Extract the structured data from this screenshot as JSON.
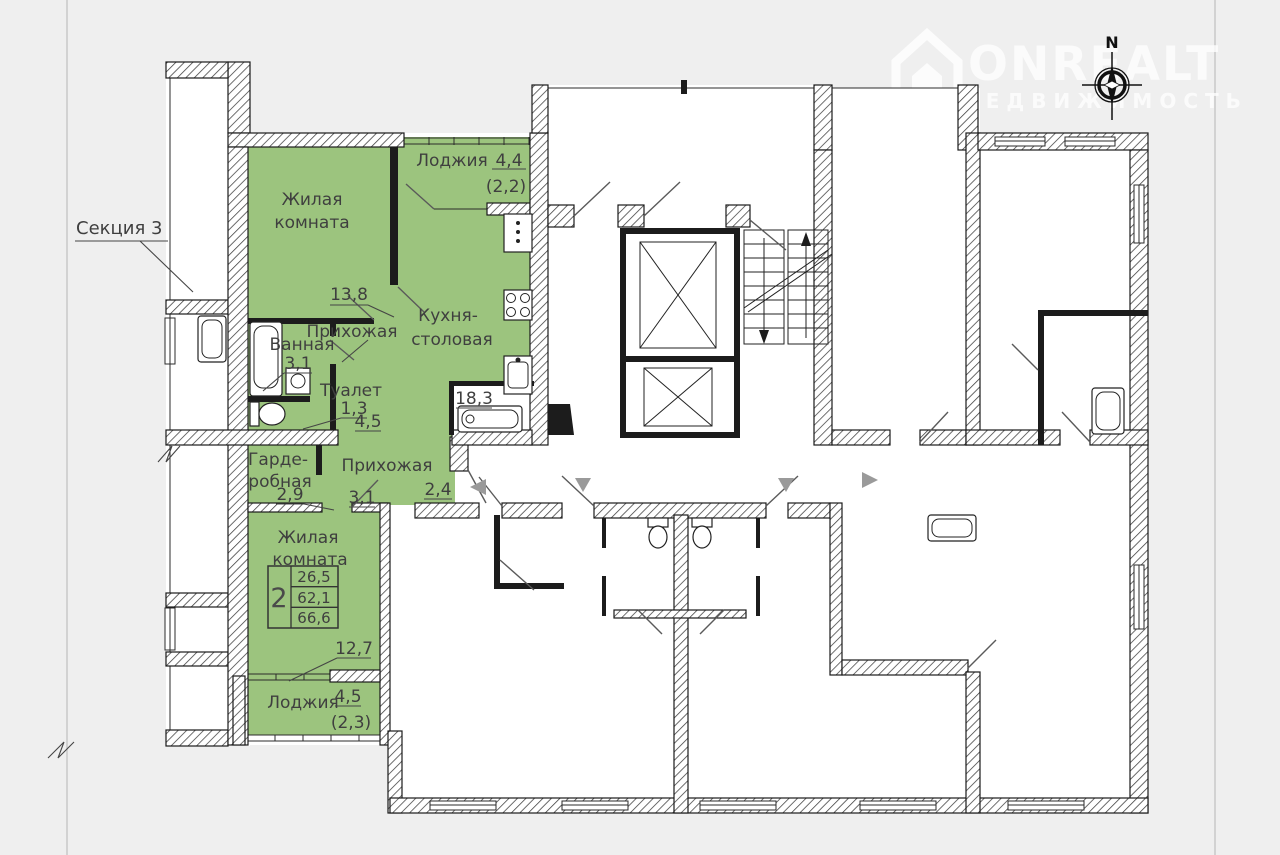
{
  "colors": {
    "background": "#efefef",
    "paper": "#ffffff",
    "wall": "#1a1a1a",
    "highlight": "#9cc47e",
    "arrow": "#9a9a9a",
    "text": "#3f3f3f"
  },
  "watermark": {
    "brand": "ONREALT",
    "tagline": "НЕДВИЖИМОСТЬ"
  },
  "compass": {
    "north": "N"
  },
  "plan": {
    "section_label": "Секция 3",
    "rooms": [
      {
        "name_line1": "Жилая",
        "name_line2": "комната",
        "area": "13,8"
      },
      {
        "name": "Лоджия",
        "area": "4,4",
        "area_reduced": "(2,2)"
      },
      {
        "name_line1": "Кухня-",
        "name_line2": "столовая",
        "area": "18,3"
      },
      {
        "name": "Ванная",
        "area": "3,1"
      },
      {
        "name": "Туалет",
        "area": "1,3"
      },
      {
        "name": "Прихожая",
        "area": "4,5"
      },
      {
        "name_line1": "Гарде-",
        "name_line2": "робная",
        "area": "2,9"
      },
      {
        "name": "Прихожая",
        "area": "3,1",
        "area2": "2,4"
      },
      {
        "name_line1": "Жилая",
        "name_line2": "комната",
        "area": "12,7"
      },
      {
        "name": "Лоджия",
        "area": "4,5",
        "area_reduced": "(2,3)"
      }
    ],
    "stamp": {
      "rooms": "2",
      "living_area": "26,5",
      "apartment_area": "62,1",
      "total_area": "66,6"
    }
  }
}
